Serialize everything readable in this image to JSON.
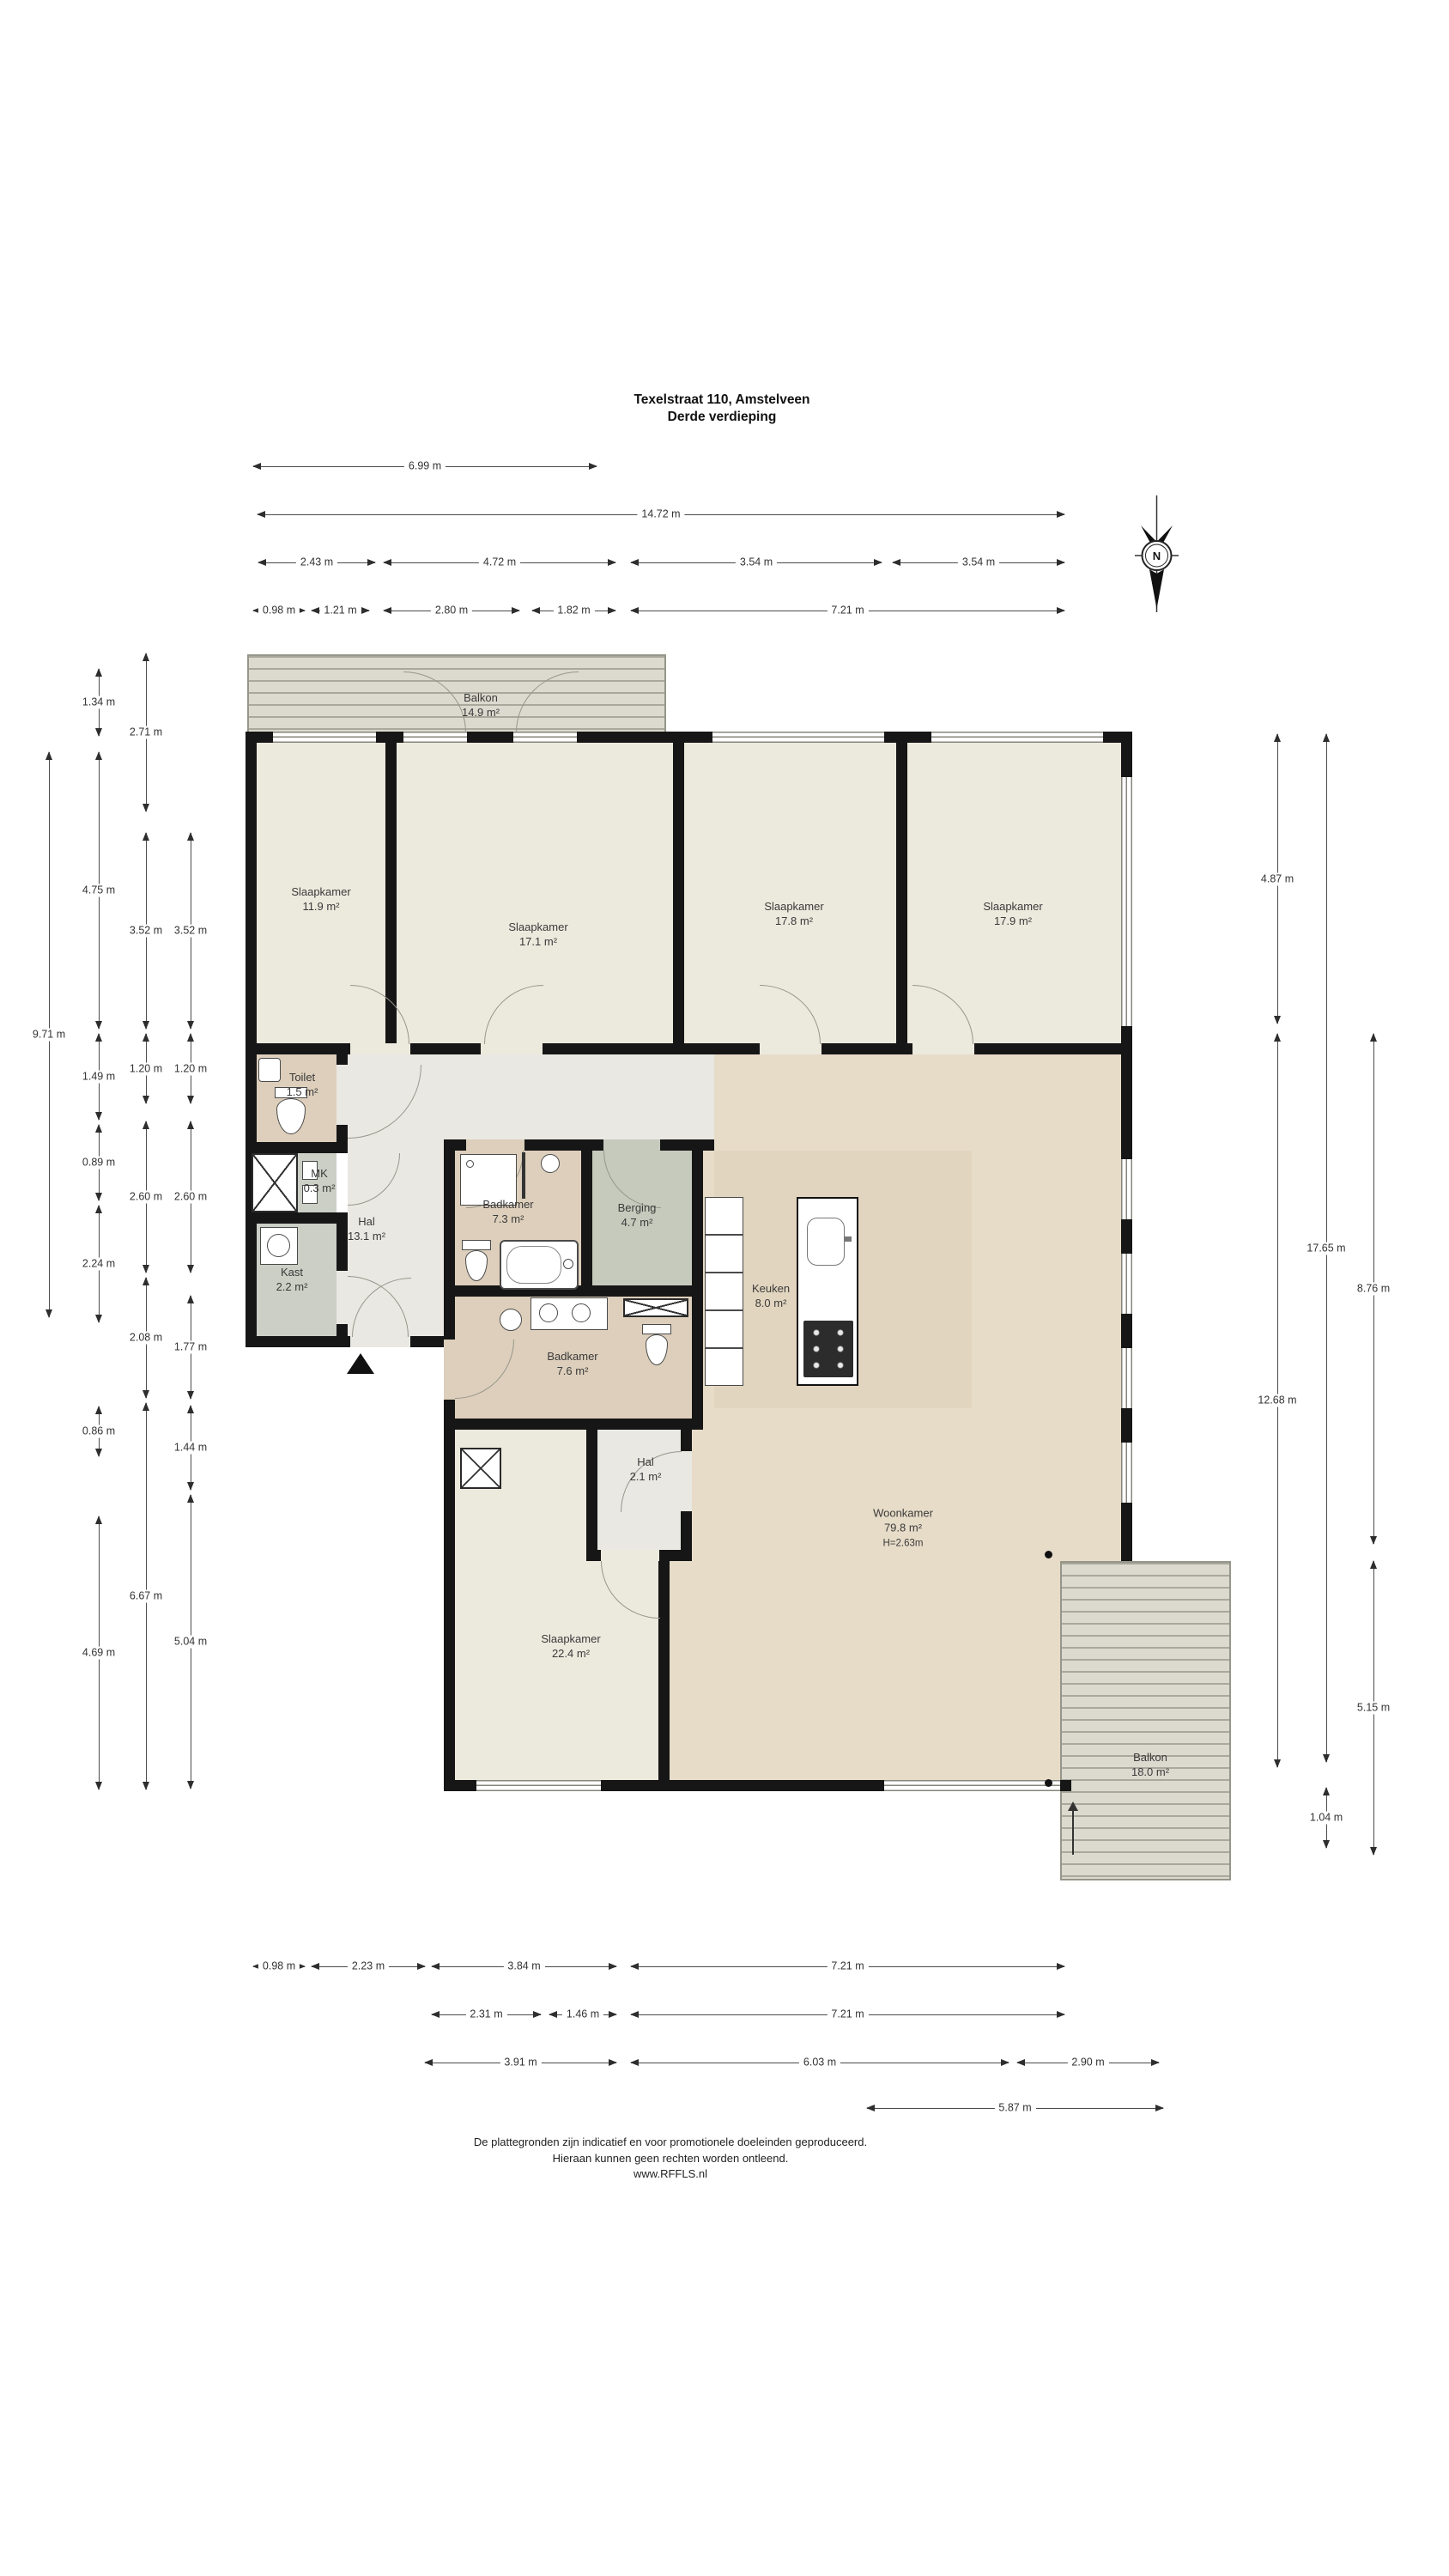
{
  "title": {
    "line1": "Texelstraat 110, Amstelveen",
    "line2": "Derde verdieping"
  },
  "compass": {
    "letter": "N"
  },
  "rooms": {
    "balkon_top": {
      "name": "Balkon",
      "area": "14.9 m²"
    },
    "sl119": {
      "name": "Slaapkamer",
      "area": "11.9 m²"
    },
    "sl171": {
      "name": "Slaapkamer",
      "area": "17.1 m²"
    },
    "sl178": {
      "name": "Slaapkamer",
      "area": "17.8 m²"
    },
    "sl179": {
      "name": "Slaapkamer",
      "area": "17.9 m²"
    },
    "toilet": {
      "name": "Toilet",
      "area": "1.5 m²"
    },
    "mk": {
      "name": "MK",
      "area": "0.3 m²"
    },
    "hal": {
      "name": "Hal",
      "area": "13.1 m²"
    },
    "badkamer73": {
      "name": "Badkamer",
      "area": "7.3 m²"
    },
    "berging": {
      "name": "Berging",
      "area": "4.7 m²"
    },
    "kast": {
      "name": "Kast",
      "area": "2.2 m²"
    },
    "keuken": {
      "name": "Keuken",
      "area": "8.0 m²"
    },
    "badkamer76": {
      "name": "Badkamer",
      "area": "7.6 m²"
    },
    "hal21": {
      "name": "Hal",
      "area": "2.1 m²"
    },
    "sl224": {
      "name": "Slaapkamer",
      "area": "22.4 m²"
    },
    "woonkamer": {
      "name": "Woonkamer",
      "area": "79.8 m²",
      "height": "H=2.63m"
    },
    "balkon_bottom": {
      "name": "Balkon",
      "area": "18.0 m²"
    }
  },
  "dimensions": {
    "top": {
      "r1": [
        "6.99 m"
      ],
      "r2": [
        "14.72 m"
      ],
      "r3": [
        "2.43 m",
        "4.72 m",
        "3.54 m",
        "3.54 m"
      ],
      "r4": [
        "0.98 m",
        "1.21 m",
        "2.80 m",
        "1.82 m",
        "7.21 m"
      ]
    },
    "left": {
      "c0": [
        "9.71 m"
      ],
      "c1": [
        "1.34 m",
        "4.75 m",
        "1.49 m",
        "0.89 m",
        "2.24 m",
        "0.86 m",
        "4.69 m"
      ],
      "c2": [
        "2.71 m",
        "3.52 m",
        "1.20 m",
        "2.60 m",
        "2.08 m",
        "6.67 m"
      ],
      "c3": [
        "3.52 m",
        "1.20 m",
        "2.60 m",
        "1.77 m",
        "1.44 m",
        "5.04 m"
      ]
    },
    "right": {
      "cA": [
        "4.87 m",
        "12.68 m"
      ],
      "cB": [
        "17.65 m",
        "1.04 m"
      ],
      "cC": [
        "8.76 m",
        "5.15 m"
      ]
    },
    "bottom": {
      "r1": [
        "0.98 m",
        "2.23 m",
        "3.84 m",
        "7.21 m"
      ],
      "r2": [
        "2.31 m",
        "1.46 m",
        "7.21 m"
      ],
      "r3": [
        "3.91 m",
        "6.03 m",
        "2.90 m"
      ],
      "r4": [
        "5.87 m"
      ]
    }
  },
  "footer": {
    "line1": "De plattegronden zijn indicatief en voor promotionele doeleinden geproduceerd.",
    "line2": "Hieraan kunnen geen rechten worden ontleend.",
    "line3": "www.RFFLS.nl"
  },
  "colors": {
    "wall": "#161616",
    "bedroom_floor": "#ece9dd",
    "bath_floor": "#ddcfbb",
    "living_floor": "#e7dcc8",
    "kitchen_floor": "#e2d5bf",
    "storage_floor": "#c6cabc",
    "closet_floor": "#cbcfc5",
    "hall_floor": "#e9e8e2",
    "balcony_floor": "#dcdacf",
    "balcony_stripe": "#a8a89c",
    "dimension_line": "#4a4a4a"
  }
}
